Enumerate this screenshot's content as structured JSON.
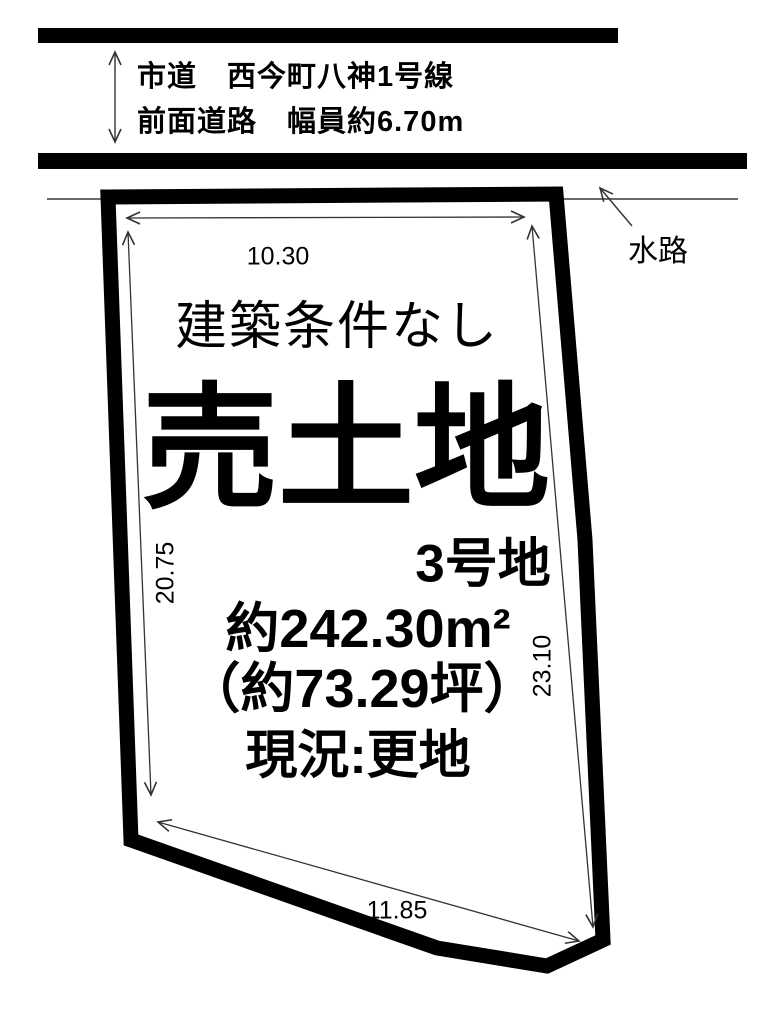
{
  "colors": {
    "ink": "#000000",
    "paper": "#ffffff",
    "thin_line": "#333333",
    "waterway_line": "#555555"
  },
  "road": {
    "name": "市道　西今町八神1号線",
    "front_width": "前面道路　幅員約6.70m"
  },
  "waterway": {
    "label": "水路"
  },
  "plot": {
    "condition": "建築条件なし",
    "title": "売土地",
    "lot_no": "3号地",
    "area_m2": "約242.30m²",
    "area_tsubo": "（約73.29坪）",
    "status": "現況:更地"
  },
  "dimensions": {
    "top_width": "10.30",
    "left_depth": "20.75",
    "right_depth": "23.10",
    "bottom_width": "11.85"
  }
}
